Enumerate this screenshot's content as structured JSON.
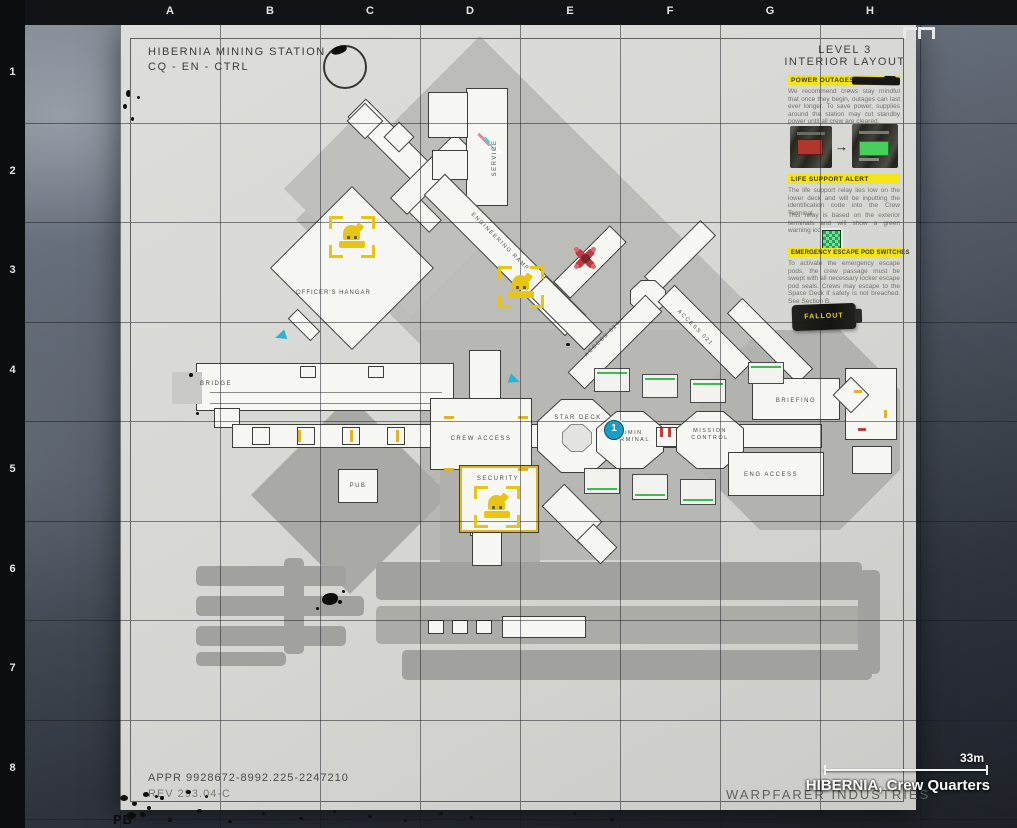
{
  "grid": {
    "columns": [
      "A",
      "B",
      "C",
      "D",
      "E",
      "F",
      "G",
      "H"
    ],
    "rows": [
      "1",
      "2",
      "3",
      "4",
      "5",
      "6",
      "7",
      "8"
    ]
  },
  "title_block": {
    "station": "HIBERNIA MINING STATION",
    "designation": "CQ - EN - CTRL"
  },
  "info_panel": {
    "heading": "LEVEL 3\nINTERIOR LAYOUT",
    "sections": [
      {
        "heading": "POWER OUTAGES",
        "body": "We recommend crews stay mindful that once they begin, outages can last ever longer. To save power, supplies around the station may cut standby power until all crew are cleared."
      },
      {
        "heading": "LIFE SUPPORT ALERT",
        "body": "The life support relay lies low on the lower deck and will be inputting the identification code into the Crew Terminal.",
        "body2": "This relay is based on the exterior terminals and will show a green warning icon."
      },
      {
        "heading": "EMERGENCY ESCAPE POD SWITCHES",
        "body": "To activate the emergency escape pods, the crew passage must be swept with all necessary locker escape pod seals. Crews may escape to the Space Deck if safety is not breached. See Section B."
      }
    ],
    "battery_label": "FALLOUT"
  },
  "rooms": {
    "officers_hangar": "OFFICER'S HANGAR",
    "service": "SERVICE",
    "engineering_ramp": "ENGINEERING RAMP",
    "access_024": "ACCESS 024",
    "access_021": "ACCESS 021",
    "bridge": "BRIDGE",
    "crew_access": "CREW ACCESS",
    "star_deck": "STAR DECK",
    "admin_terminal": "ADMIN\nTERMINAL",
    "mission_control": "MISSION\nCONTROL",
    "briefing": "BRIEFING",
    "eng_access": "ENG ACCESS",
    "pub": "PUB",
    "security": "SECURITY"
  },
  "markers": {
    "waypoint_1": "1"
  },
  "footer": {
    "approval": "APPR 9928672-8992.225-2247210",
    "revision": "REV 293.04-C",
    "manufacturer": "WARPFARER INDUSTRIES",
    "corner_mark": "PB"
  },
  "overlay": {
    "location": "HIBERNIA, Crew Quarters",
    "scale": "33m"
  },
  "colors": {
    "objective_yellow": "#e8c414",
    "hazard_red": "#bf3a42",
    "waypoint_blue": "#1a9dc6",
    "highlight_yellow": "#f4e41c",
    "status_green": "#3dbb52"
  }
}
